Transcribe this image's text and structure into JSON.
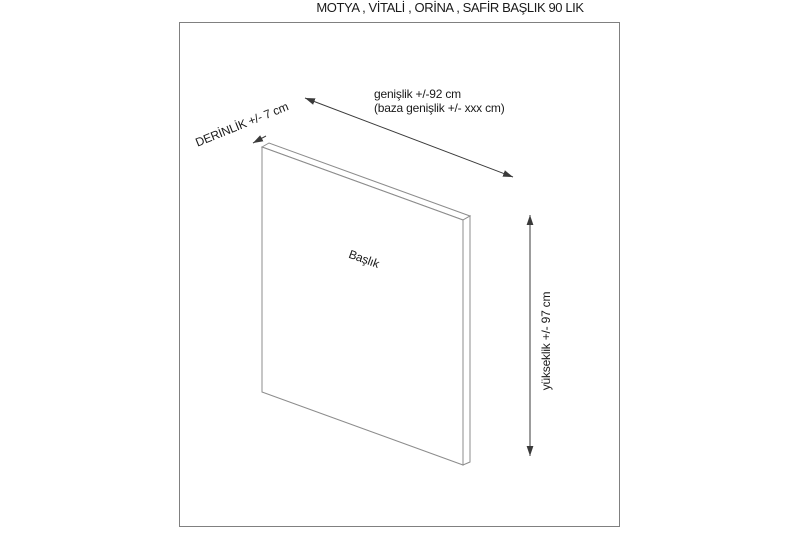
{
  "page": {
    "title": "MOTYA , VİTALİ , ORİNA , SAFİR BAŞLIK 90 LIK"
  },
  "diagram": {
    "panel_label": "Başlık",
    "depth_label": "DERİNLİK +/- 7 cm",
    "width_label_line1": "genişlik +/-92 cm",
    "width_label_line2": "(baza genişlik +/- xxx cm)",
    "height_label": "yükseklik +/- 97 cm",
    "dimensions": {
      "depth_cm": "+/- 7",
      "width_cm": "+/-92",
      "baza_width_cm": "+/- xxx",
      "height_cm": "+/- 97"
    },
    "colors": {
      "background": "#ffffff",
      "frame_border": "#808080",
      "panel_stroke": "#8c8c8c",
      "dimension_stroke": "#3a3a3a",
      "text": "#1a1a1a"
    }
  }
}
